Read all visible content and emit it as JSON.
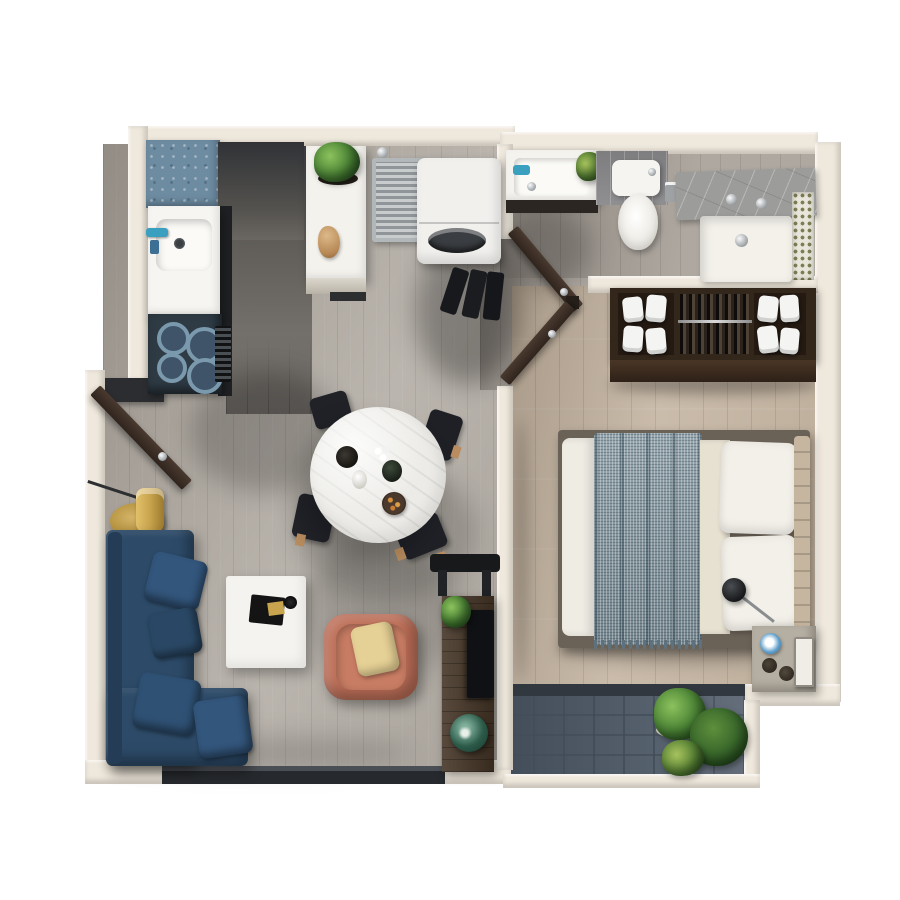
{
  "scene": {
    "kind": "3d-rendered-apartment-floor-plan-top-view",
    "background": "#ffffff"
  },
  "palette": {
    "wall": "#efe8dc",
    "wall_dark_stub": "#2b2d30",
    "floor_living": "#b3ada5",
    "floor_corridor": "#6b6763",
    "floor_bath": "#a8a199",
    "floor_bedroom": "#c4b4a1",
    "balcony_tile": "#4d5864",
    "threshold_dark": "#32383f",
    "window_dark": "#26292d",
    "counter_blue": "#6d8ba1",
    "cabinet_dark": "#3a3c40",
    "counter_edge": "#1e2023",
    "sink_white": "#f7f5f1",
    "stove_dark": "#2e3a44",
    "burner_fill": "#3f5468",
    "console_white": "#f4f2ed",
    "radiator_grey": "#9aa0a3",
    "washer_white": "#f1f0ed",
    "drum_dark": "#3a3d41",
    "shoes_dark": "#17191c",
    "door_brown": "#3c2f26",
    "vanity_white": "#f5f3ee",
    "faucet_teal": "#3ba0bf",
    "toilet_white": "#f6f4f0",
    "shower_tray": "#f3f1ea",
    "closet_brown": "#33261b",
    "closet_interior": "#241a12",
    "closet_face": "#4a3626",
    "towel_white": "#f4f4f2",
    "bed_frame": "#6b6257",
    "mattress_white": "#efece4",
    "blanket_grey_blue": "#8496a0",
    "sheet_cream": "#e7e1d2",
    "pillow_white": "#f3f0e9",
    "headboard_tan": "#c6b6a0",
    "lamp_black": "#1a1a1c",
    "nightstand_grey": "#b5aea2",
    "cup_blue": "#5b9cc9",
    "book_white": "#f0ede6",
    "sofa_navy": "#2d4b69",
    "sofa_pillow": "#33567c",
    "gold": "#c9a44e",
    "coffee_table_white": "#f5f3ef",
    "armchair_terracotta": "#bd6f58",
    "armchair_pillow": "#e5d095",
    "dining_table_white": "#ecebe7",
    "chair_black": "#202228",
    "wood_tan": "#b98d5f",
    "desk_wood": "#453526",
    "monitor_dark": "#101114",
    "vase_green": "#2c5a49",
    "plant_green": "#4e8637",
    "plant_dark": "#2e5c24"
  },
  "rooms": [
    {
      "name": "kitchen"
    },
    {
      "name": "laundry-nook"
    },
    {
      "name": "bathroom"
    },
    {
      "name": "wardrobe-closet"
    },
    {
      "name": "bedroom"
    },
    {
      "name": "living-dining-room"
    },
    {
      "name": "balcony"
    }
  ],
  "objects": [
    {
      "name": "blue-kitchen-counter"
    },
    {
      "name": "kitchen-sink"
    },
    {
      "name": "cooktop"
    },
    {
      "name": "tall-cabinet"
    },
    {
      "name": "island-console"
    },
    {
      "name": "console-plant"
    },
    {
      "name": "decor-figurine"
    },
    {
      "name": "drying-rack"
    },
    {
      "name": "washing-machine"
    },
    {
      "name": "shoe-rack"
    },
    {
      "name": "entry-door"
    },
    {
      "name": "bathroom-door"
    },
    {
      "name": "bedroom-door"
    },
    {
      "name": "bathroom-vanity"
    },
    {
      "name": "toilet"
    },
    {
      "name": "shower"
    },
    {
      "name": "mosaic-tile-strip"
    },
    {
      "name": "wardrobe"
    },
    {
      "name": "double-bed"
    },
    {
      "name": "reading-lamp"
    },
    {
      "name": "nightstand"
    },
    {
      "name": "balcony-plants"
    },
    {
      "name": "sliding-window"
    },
    {
      "name": "sectional-sofa"
    },
    {
      "name": "side-table-lamp"
    },
    {
      "name": "coffee-table"
    },
    {
      "name": "armchair"
    },
    {
      "name": "dining-table"
    },
    {
      "name": "dining-chairs"
    },
    {
      "name": "desk"
    },
    {
      "name": "desk-chair"
    },
    {
      "name": "desk-plant"
    },
    {
      "name": "green-vase"
    }
  ]
}
